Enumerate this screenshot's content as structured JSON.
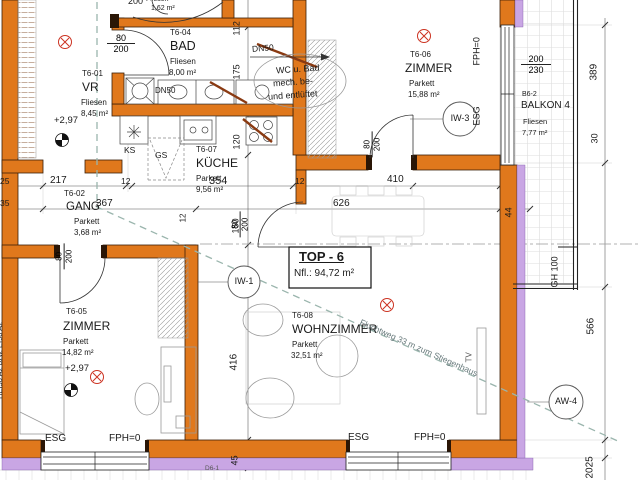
{
  "unit": {
    "title": "TOP - 6",
    "net_area": "Nfl.: 94,72 m²"
  },
  "rooms": {
    "vr": {
      "id": "T6-01",
      "name": "VR",
      "floor": "Fliesen",
      "area": "8,45 m²",
      "level": "+2,97"
    },
    "gang": {
      "id": "T6-02",
      "name": "GANG",
      "floor": "Parkett",
      "area": "3,68 m²"
    },
    "bad": {
      "id": "T6-04",
      "name": "BAD",
      "floor": "Fliesen",
      "area": "8,00 m²"
    },
    "zimmer_sued": {
      "id": "T6-05",
      "name": "ZIMMER",
      "floor": "Parkett",
      "area": "14,82 m²",
      "level": "+2,97"
    },
    "zimmer_nord": {
      "id": "T6-06",
      "name": "ZIMMER",
      "floor": "Parkett",
      "area": "15,88 m²"
    },
    "kueche": {
      "id": "T6-07",
      "name": "KÜCHE",
      "floor": "Parkett",
      "area": "9,56 m²"
    },
    "wohnzimmer": {
      "id": "T6-08",
      "name": "WOHNZIMMER",
      "floor": "Parkett",
      "area": "32,51 m²"
    },
    "balkon": {
      "id": "B6-2",
      "name": "BALKON 4",
      "floor": "Fliesen",
      "area": "7,77 m²"
    },
    "wc_top": {
      "floor": "Fliesen",
      "area": "1,62 m²"
    }
  },
  "doors": {
    "w": "80",
    "h": "200",
    "top": "200"
  },
  "window_right": {
    "w": "200",
    "h": "230"
  },
  "vent": {
    "dn": "DN50",
    "note1": "WC u. Bad",
    "note2": "mech. be-",
    "note3": "und entlüftet"
  },
  "escape": {
    "label": "Fluchtweg 33 m zum Stiegenhaus"
  },
  "fire": {
    "label": "HEI90 A2 bzw. EI90 A2"
  },
  "tags": {
    "iw1": "IW-1",
    "iw3": "IW-3",
    "aw4": "AW-4",
    "d6": "D6-1"
  },
  "glass": {
    "esg": "ESG",
    "fph": "FPH=0",
    "gh": "GH 100"
  },
  "appliances": {
    "ks": "KS",
    "gs": "GS",
    "tv": "TV"
  },
  "dims": {
    "r1a": "217",
    "r1b": "12",
    "r1c": "354",
    "r1d": "12",
    "r1e": "410",
    "r2a": "367",
    "r2b": "626",
    "r2c": "44",
    "v1": "112",
    "v2": "175",
    "v3": "120",
    "v4": "150",
    "v5": "416",
    "v6": "45",
    "w12": "12",
    "right1": "389",
    "right2": "30",
    "right3": "566",
    "right4": "2025",
    "la": "25",
    "lb": "35"
  },
  "colors": {
    "wall": "#e0781c",
    "insulation": "#c9a6e4",
    "escape_route": "#9ab5ad",
    "symbol_red": "#cc3322",
    "duct": "#8a3a12"
  }
}
